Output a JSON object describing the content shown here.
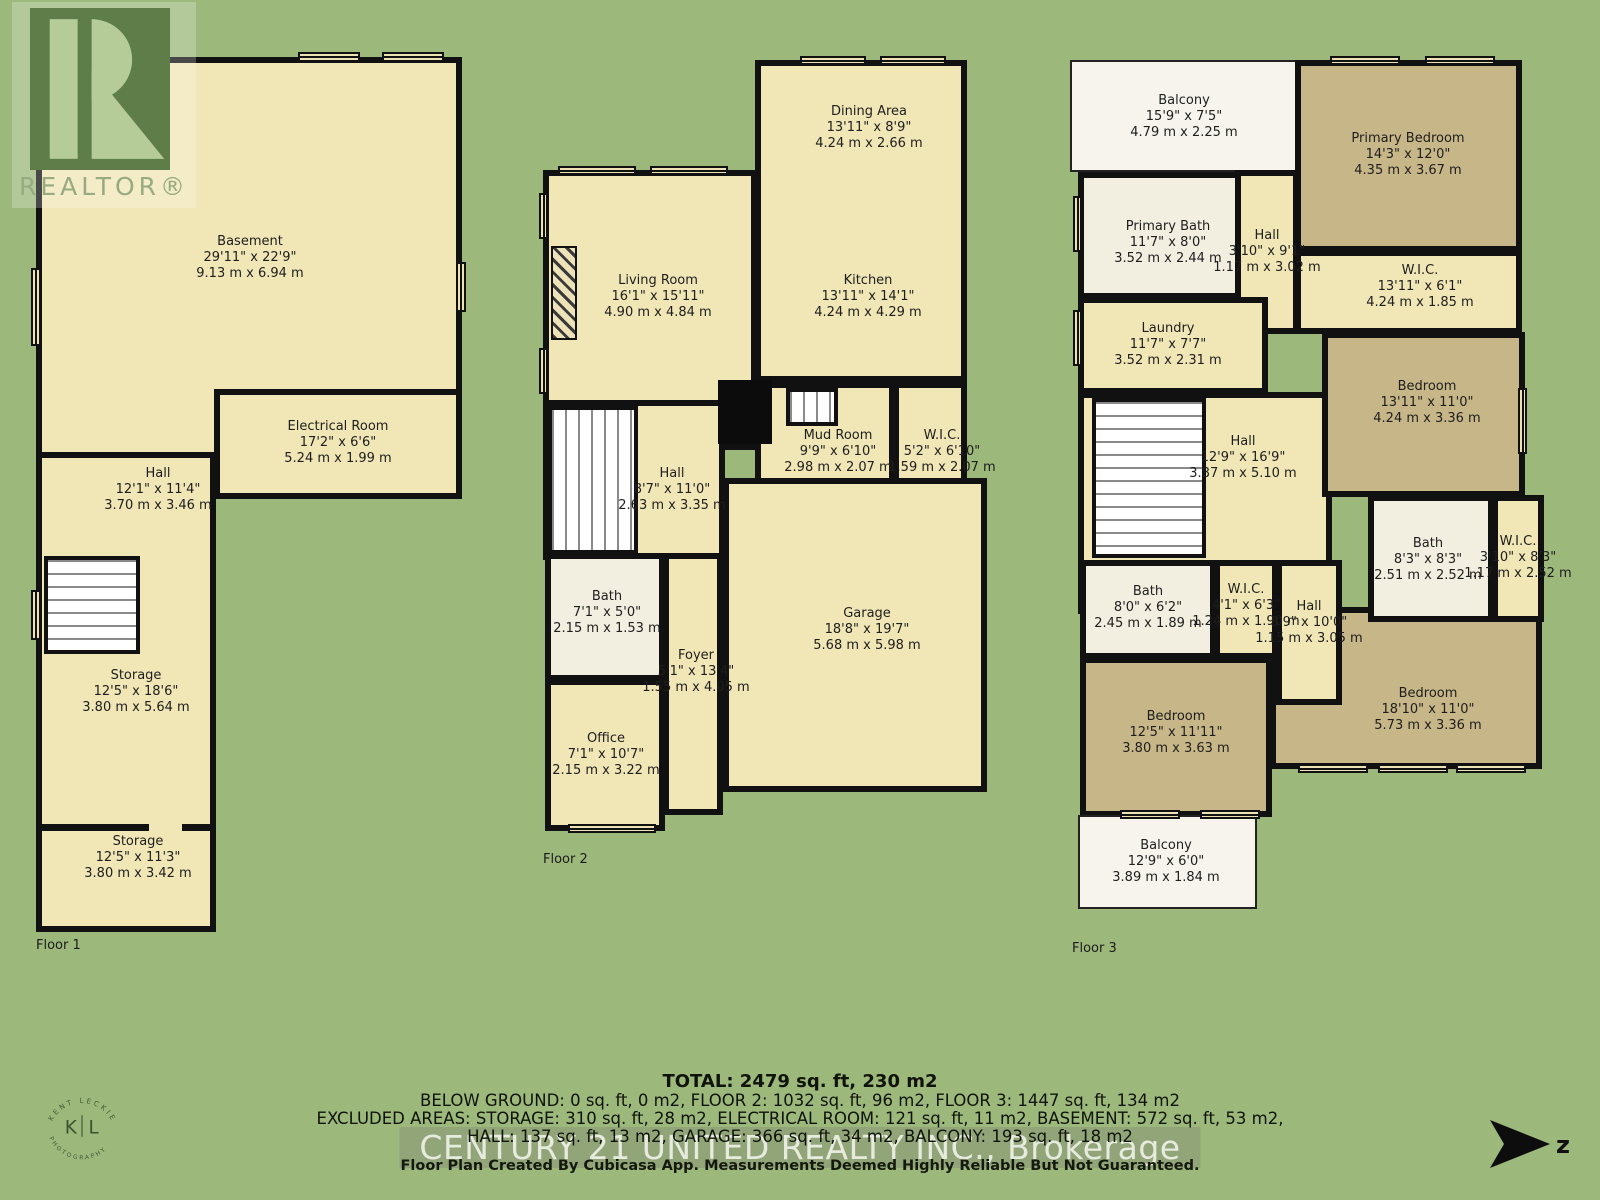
{
  "logo": {
    "brand": "REALTOR®"
  },
  "kl_logo": {
    "arc_top": "KENT LECKIE",
    "arc_bottom": "PHOTOGRAPHY",
    "left": "K",
    "right": "L"
  },
  "north": {
    "label": "z"
  },
  "colors": {
    "background": "#9cb87b",
    "room_cream": "#f0e6b6",
    "room_tan": "#c7b687",
    "room_white": "#f2eee0",
    "balcony": "#f6f4ed",
    "wall": "#111111"
  },
  "floors": [
    {
      "label": "Floor 1",
      "rooms": [
        {
          "name": "Basement",
          "ft": "29'11\" x 22'9\"",
          "m": "9.13 m x 6.94 m"
        },
        {
          "name": "Electrical Room",
          "ft": "17'2\" x 6'6\"",
          "m": "5.24 m x 1.99 m"
        },
        {
          "name": "Hall",
          "ft": "12'1\" x 11'4\"",
          "m": "3.70 m x 3.46 m"
        },
        {
          "name": "Storage",
          "ft": "12'5\" x 18'6\"",
          "m": "3.80 m x 5.64 m"
        },
        {
          "name": "Storage",
          "ft": "12'5\" x 11'3\"",
          "m": "3.80 m x 3.42 m"
        }
      ]
    },
    {
      "label": "Floor 2",
      "rooms": [
        {
          "name": "Dining Area",
          "ft": "13'11\" x 8'9\"",
          "m": "4.24 m x 2.66 m"
        },
        {
          "name": "Living Room",
          "ft": "16'1\" x 15'11\"",
          "m": "4.90 m x 4.84 m"
        },
        {
          "name": "Kitchen",
          "ft": "13'11\" x 14'1\"",
          "m": "4.24 m x 4.29 m"
        },
        {
          "name": "Mud Room",
          "ft": "9'9\" x 6'10\"",
          "m": "2.98 m x 2.07 m"
        },
        {
          "name": "W.I.C.",
          "ft": "5'2\" x 6'10\"",
          "m": "1.59 m x 2.07 m"
        },
        {
          "name": "Hall",
          "ft": "8'7\" x 11'0\"",
          "m": "2.63 m x 3.35 m"
        },
        {
          "name": "Bath",
          "ft": "7'1\" x 5'0\"",
          "m": "2.15 m x 1.53 m"
        },
        {
          "name": "Foyer",
          "ft": "5'1\" x 13'4\"",
          "m": "1.55 m x 4.05 m"
        },
        {
          "name": "Office",
          "ft": "7'1\" x 10'7\"",
          "m": "2.15 m x 3.22 m"
        },
        {
          "name": "Garage",
          "ft": "18'8\" x 19'7\"",
          "m": "5.68 m x 5.98 m"
        }
      ]
    },
    {
      "label": "Floor 3",
      "rooms": [
        {
          "name": "Balcony",
          "ft": "15'9\" x 7'5\"",
          "m": "4.79 m x 2.25 m"
        },
        {
          "name": "Primary Bedroom",
          "ft": "14'3\" x 12'0\"",
          "m": "4.35 m x 3.67 m"
        },
        {
          "name": "Primary Bath",
          "ft": "11'7\" x 8'0\"",
          "m": "3.52 m x 2.44 m"
        },
        {
          "name": "Hall",
          "ft": "3'10\" x 9'1\"",
          "m": "1.17 m x 3.02 m"
        },
        {
          "name": "W.I.C.",
          "ft": "13'11\" x 6'1\"",
          "m": "4.24 m x 1.85 m"
        },
        {
          "name": "Laundry",
          "ft": "11'7\" x 7'7\"",
          "m": "3.52 m x 2.31 m"
        },
        {
          "name": "Hall",
          "ft": "12'9\" x 16'9\"",
          "m": "3.87 m x 5.10 m"
        },
        {
          "name": "Bedroom",
          "ft": "13'11\" x 11'0\"",
          "m": "4.24 m x 3.36 m"
        },
        {
          "name": "Bath",
          "ft": "8'3\" x 8'3\"",
          "m": "2.51 m x 2.52 m"
        },
        {
          "name": "W.I.C.",
          "ft": "3'10\" x 8'3\"",
          "m": "1.17 m x 2.52 m"
        },
        {
          "name": "Bath",
          "ft": "8'0\" x 6'2\"",
          "m": "2.45 m x 1.89 m"
        },
        {
          "name": "W.I.C.",
          "ft": "4'1\" x 6'3\"",
          "m": "1.24 m x 1.90 m"
        },
        {
          "name": "Hall",
          "ft": "3'9\" x 10'0\"",
          "m": "1.15 m x 3.05 m"
        },
        {
          "name": "Bedroom",
          "ft": "12'5\" x 11'11\"",
          "m": "3.80 m x 3.63 m"
        },
        {
          "name": "Bedroom",
          "ft": "18'10\" x 11'0\"",
          "m": "5.73 m x 3.36 m"
        },
        {
          "name": "Balcony",
          "ft": "12'9\" x 6'0\"",
          "m": "3.89 m x 1.84 m"
        }
      ]
    }
  ],
  "summary": {
    "total": "TOTAL: 2479 sq. ft, 230 m2",
    "line2": "BELOW GROUND: 0 sq. ft, 0 m2, FLOOR 2: 1032 sq. ft, 96 m2, FLOOR 3: 1447 sq. ft, 134 m2",
    "line3": "EXCLUDED AREAS: STORAGE: 310 sq. ft, 28 m2, ELECTRICAL ROOM: 121 sq. ft, 11 m2, BASEMENT: 572 sq. ft, 53 m2,",
    "line4": "HALL: 137 sq. ft, 13 m2, GARAGE: 366 sq. ft, 34 m2, BALCONY: 193 sq. ft, 18 m2"
  },
  "watermark": "CENTURY 21 UNITED REALTY INC., Brokerage",
  "disclaimer": "Floor Plan Created By Cubicasa App. Measurements Deemed Highly Reliable But Not Guaranteed."
}
